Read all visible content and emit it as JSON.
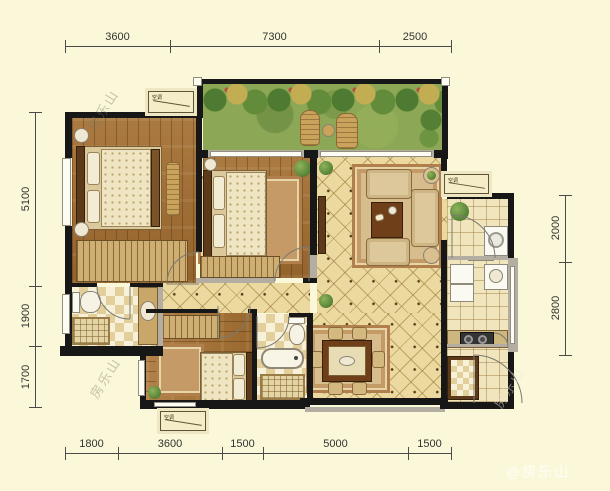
{
  "dims": {
    "top": [
      "3600",
      "7300",
      "2500"
    ],
    "bottom": [
      "1800",
      "3600",
      "1500",
      "5000",
      "1500"
    ],
    "left": [
      "5100",
      "1900",
      "1700"
    ],
    "right": [
      "2000",
      "2800"
    ]
  },
  "labels": {
    "ac_platform": "空调"
  },
  "watermarks": {
    "diagonal": "房乐山",
    "corner": "@房乐山"
  },
  "colors": {
    "background": "#faf8d8",
    "wall": "#171717",
    "secondary_wall": "#b3ada2",
    "wood_floor": "#a2713a",
    "tile_floor": "#ecd9a0",
    "bath_tile": "#f8f1d9",
    "grass": "#8ca755"
  }
}
